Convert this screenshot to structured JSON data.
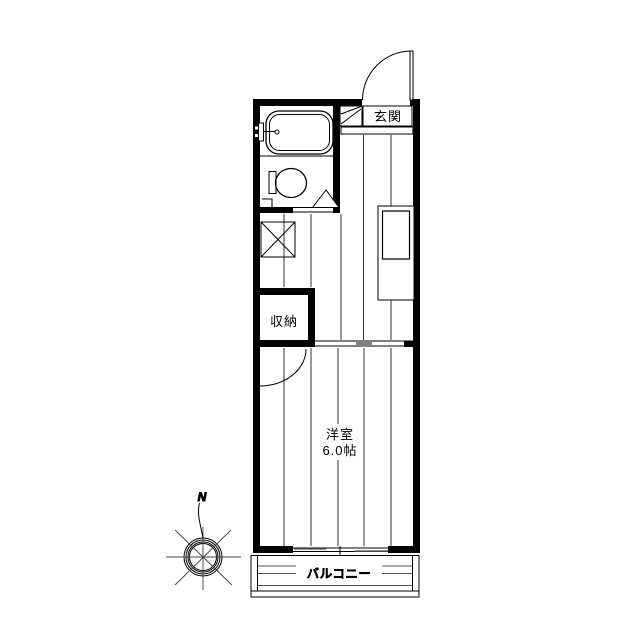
{
  "plan": {
    "entrance_label": "玄関",
    "storage_label": "収納",
    "room_label": "洋室",
    "room_area": "6.0帖",
    "balcony_label": "バルコニー"
  },
  "compass": {
    "north_label": "N"
  },
  "colors": {
    "line": "#000000",
    "wall_fill": "#000000",
    "door_panel_gray": "#808080",
    "background": "#ffffff"
  }
}
